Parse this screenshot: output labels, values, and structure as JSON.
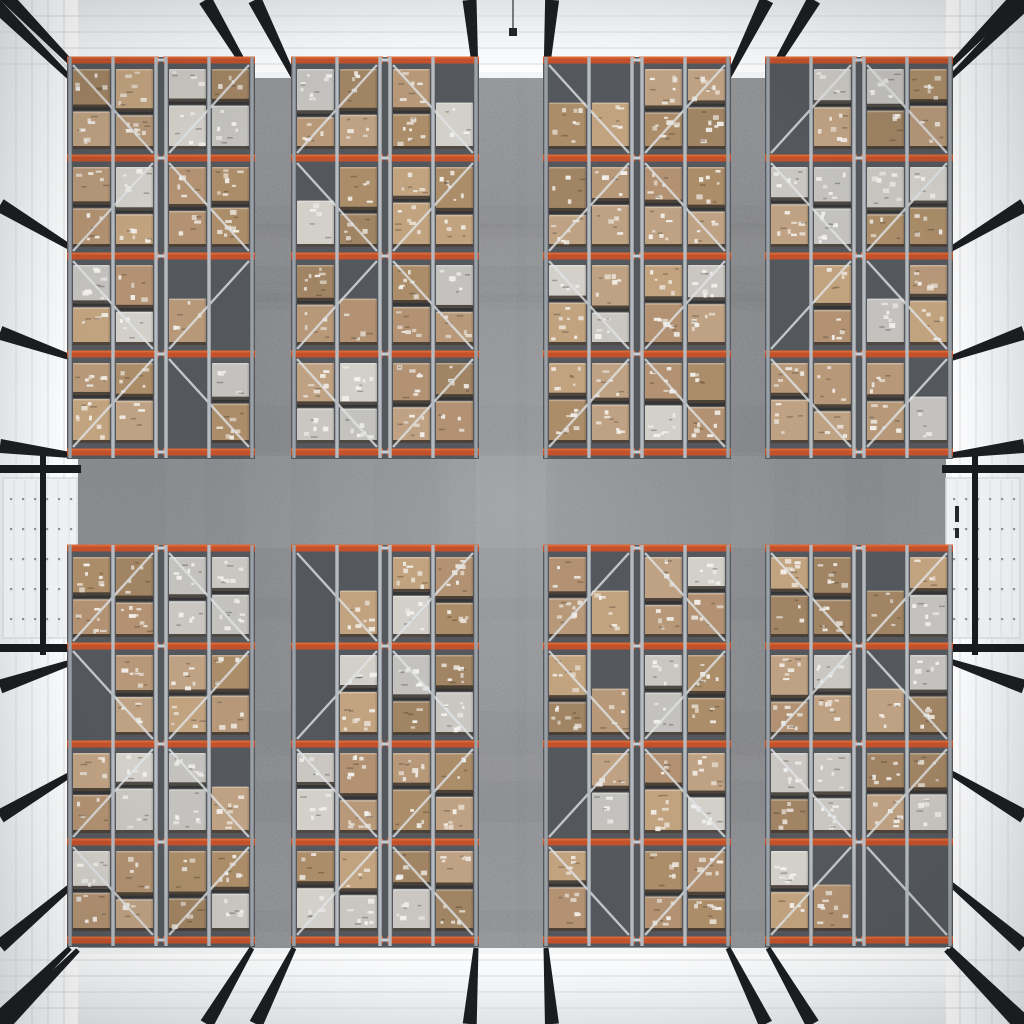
{
  "scene": {
    "subject": "overhead-view-warehouse-interior-with-pallet-racks",
    "canvas": {
      "width": 1024,
      "height": 1024
    },
    "palette": {
      "wallEdge": "#e6e9ec",
      "wallBright": "#f9fafb",
      "wallSeam": "#d9dde1",
      "skirting": "#f3f5f7",
      "rafterBlack": "#1b1d20",
      "floorLight": "#a6a8ab",
      "floorMid": "#95979b",
      "underRack": "#54585c",
      "orangeBeam": "#c2512c",
      "orangeHighlight": "#e06c36",
      "steelUpright": "#b5bbc0",
      "steelFrame": "#9aa1a7",
      "steelBrace": "#e1e5e8",
      "steelRail": "#c8ced2",
      "boxTans": [
        "#b7997a",
        "#ab8d69",
        "#c2a37f",
        "#b29272",
        "#a08463",
        "#bfa283"
      ],
      "boxPale": [
        "#cac7c2",
        "#d3d0ca",
        "#c3c2be"
      ],
      "palletDark": "#3a332d",
      "boxSeam": "rgba(28,24,20,0.55)",
      "labelWhite": "#f5f3ef",
      "doorPanel": "#eef0f2",
      "doorSeam": "#dde0e4",
      "doorDot": "#6f7478",
      "doorFrame": "#191b1e",
      "doorSlot": "#26282b",
      "lampWire": "#5b5e61",
      "lampBody": "#232527",
      "centerGlow": "rgba(255,255,255,0.18)",
      "aisleGlow": "rgba(255,255,255,0.06)",
      "vignette": "rgba(18,20,22,0.12)"
    },
    "floor": {
      "x": 78,
      "y": 78,
      "w": 868,
      "h": 870
    },
    "walls": {
      "seamStep": 16,
      "seamCount": 4,
      "rafterBasesTopBottom": [
        70,
        252,
        294,
        476,
        546,
        728,
        768,
        950
      ],
      "rafterBasesSides": [
        70,
        252,
        360,
        456,
        660,
        770,
        880,
        950
      ],
      "rafterBaseWidth": 5,
      "rafterOuterWidth": 14
    },
    "doors": {
      "left": {
        "x": 3,
        "y": 478,
        "w": 74,
        "h": 160
      },
      "right": {
        "x": 946,
        "y": 478,
        "w": 74,
        "h": 160
      },
      "dotColStep": 12,
      "dotRowStep": 30,
      "seamStep": 11
    },
    "lamp": {
      "x": 513,
      "wireLen": 30,
      "size": 8
    },
    "racks": {
      "rowLevels": [
        [
          60,
          158,
          256,
          354,
          452
        ],
        [
          548,
          646,
          744,
          842,
          940
        ]
      ],
      "groupsX": [
        70,
        294,
        546,
        768
      ],
      "groupW": 182,
      "lanesX": [
        0,
        43,
        96,
        139
      ],
      "laneW": 43,
      "subracksX": [
        0,
        96
      ],
      "subW": 86,
      "gapW": 10,
      "seed": 20,
      "probEmpty": 0.09,
      "probSingle": 0.08,
      "probPale": 0.26
    }
  }
}
